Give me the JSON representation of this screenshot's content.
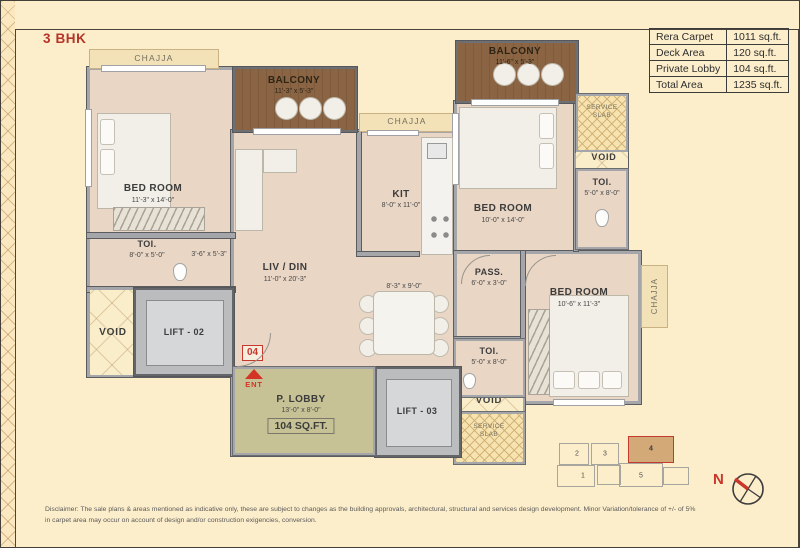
{
  "title": "3 BHK",
  "area_table": {
    "rows": [
      {
        "label": "Rera Carpet",
        "value": "1011 sq.ft."
      },
      {
        "label": "Deck Area",
        "value": "120 sq.ft."
      },
      {
        "label": "Private Lobby",
        "value": "104 sq.ft."
      },
      {
        "label": "Total Area",
        "value": "1235 sq.ft."
      }
    ]
  },
  "plan": {
    "chajja": "CHAJJA",
    "void": "VOID",
    "service_slab": "SERVICE SLAB",
    "bedroom1": {
      "name": "BED ROOM",
      "dim": "11'-3\" x 14'-0\""
    },
    "toi1": {
      "name": "TOI.",
      "dim": "8'-0\" x 5'-0\""
    },
    "pass1_dim": "3'-6\" x 5'-3\"",
    "lift2": "LIFT - 02",
    "lift3": "LIFT - 03",
    "balcony1": {
      "name": "BALCONY",
      "dim": "11'-3\" x 5'-3\""
    },
    "balcony2": {
      "name": "BALCONY",
      "dim": "11'-6\" x 5'-3\""
    },
    "livdin": {
      "name": "LIV / DIN",
      "dim": "11'-0\" x 20'-3\""
    },
    "dining_dim": "8'-3\" x 9'-0\"",
    "kit": {
      "name": "KIT",
      "dim": "8'-0\" x 11'-0\""
    },
    "bedroom2": {
      "name": "BED ROOM",
      "dim": "10'-0\" x 14'-0\""
    },
    "toi2": {
      "name": "TOI.",
      "dim": "5'-0\" x 8'-0\""
    },
    "pass2": {
      "name": "PASS.",
      "dim": "6'-0\" x 3'-0\""
    },
    "bedroom3": {
      "name": "BED ROOM",
      "dim": "10'-6\" x 11'-3\""
    },
    "toi3": {
      "name": "TOI.",
      "dim": "5'-0\" x 8'-0\""
    },
    "plobby": {
      "name": "P. LOBBY",
      "dim": "13'-0\" x 8'-0\"",
      "area": "104 SQ.FT."
    },
    "unit_number": "04",
    "ent": "ENT"
  },
  "key_plan": {
    "u1": "1",
    "u2": "2",
    "u3": "3",
    "u4": "4",
    "u5": "5",
    "highlighted_unit": "4"
  },
  "compass": {
    "label": "N"
  },
  "disclaimer": {
    "line1": "Disclaimer: The sale plans & areas mentioned as indicative only, these are subject to changes as the building approvals, architectural, structural and services design development. Minor Variation/tolerance of +/- of 5%",
    "line2": "in carpet area may occur on account of design and/or construction exigencies, conversion."
  },
  "colors": {
    "page_background": "#fdeecb",
    "carpet_fill": "#e9d6c5",
    "balcony_deck": "#8b6543",
    "private_lobby_fill": "#c6c295",
    "accent_red": "#c9362b",
    "wall_gray": "#a4a6a9"
  }
}
